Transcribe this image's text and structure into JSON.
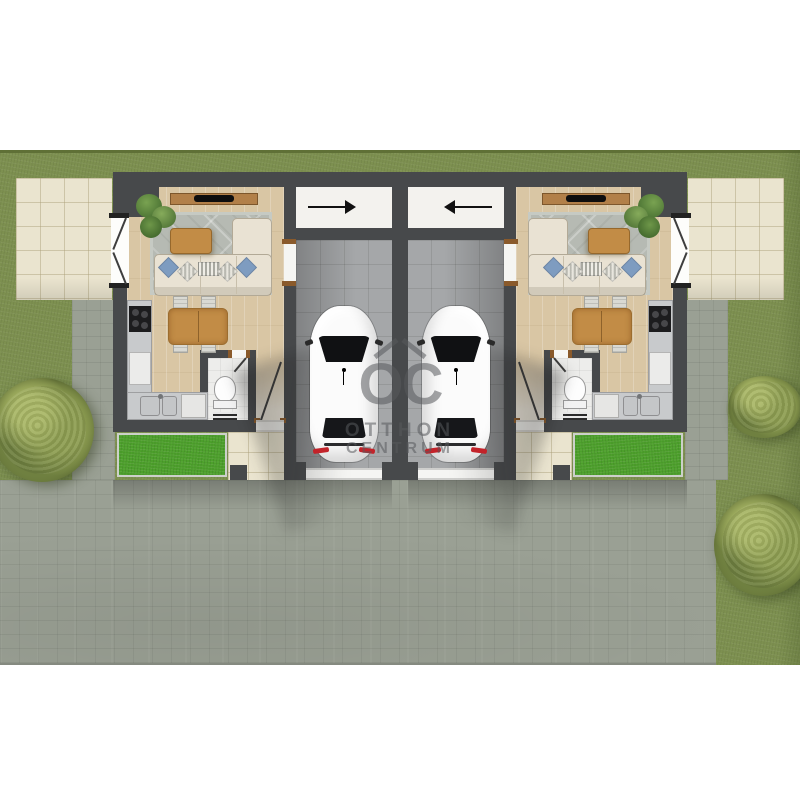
{
  "watermark": {
    "logo_text": "OC",
    "line1": "OTTHON",
    "line2": "CENTRUM"
  },
  "colors": {
    "grass": "#7d9050",
    "lawn_patch": "#4da02c",
    "driveway": "#9aa094",
    "wall": "#47494b",
    "wood_floor": "#d9c6a4",
    "terrace": "#eae4cf",
    "garage_floor": "#a5a7a9",
    "furniture_wood": "#c28c46",
    "sofa_cream": "#e9e2d3",
    "pillow_blue": "#7e9cc0",
    "car_body": "#fbfbfb",
    "taillight_red": "#c3232a",
    "foliage": "#7c8c46"
  }
}
